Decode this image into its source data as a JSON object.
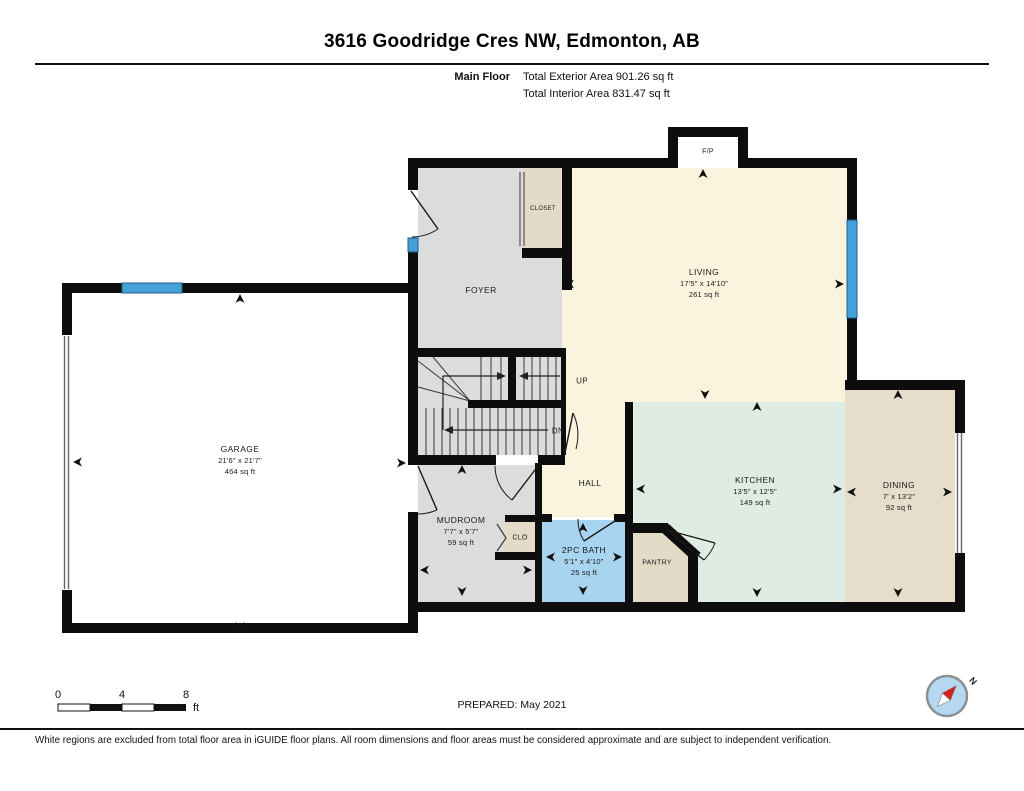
{
  "header": {
    "title": "3616 Goodridge Cres NW, Edmonton, AB"
  },
  "subheader": {
    "floor_label": "Main Floor",
    "exterior_area": "Total Exterior Area 901.26 sq ft",
    "interior_area": "Total Interior Area 831.47 sq ft"
  },
  "rooms": [
    {
      "id": "living",
      "name": "LIVING",
      "dims": "17'5\" x 14'10\"",
      "area": "261 sq ft"
    },
    {
      "id": "garage",
      "name": "GARAGE",
      "dims": "21'6\" x 21'7\"",
      "area": "464 sq ft"
    },
    {
      "id": "kitchen",
      "name": "KITCHEN",
      "dims": "13'5\" x 12'5\"",
      "area": "149 sq ft"
    },
    {
      "id": "dining",
      "name": "DINING",
      "dims": "7' x 13'2\"",
      "area": "92 sq ft"
    },
    {
      "id": "mudroom",
      "name": "MUDROOM",
      "dims": "7'7\" x 5'7\"",
      "area": "59 sq ft"
    },
    {
      "id": "bath",
      "name": "2PC BATH",
      "dims": "5'1\" x 4'10\"",
      "area": "25 sq ft"
    },
    {
      "id": "foyer",
      "name": "FOYER"
    },
    {
      "id": "hall",
      "name": "HALL"
    }
  ],
  "labels": {
    "fireplace": "F/P",
    "closet": "CLOSET",
    "clo": "CLO",
    "pantry": "PANTRY",
    "up": "UP",
    "dn": "DN"
  },
  "scale_bar": {
    "tick0": "0",
    "tick4": "4",
    "tick8": "8",
    "unit": "ft"
  },
  "compass": {
    "north": "N"
  },
  "footer": {
    "prepared": "PREPARED: May 2021",
    "disclaimer": "White regions are excluded from total floor area in iGUIDE floor plans. All room dimensions and floor areas must be considered approximate and are subject to independent verification."
  },
  "colors": {
    "wall": "#0d0d0d",
    "living_cream": "#faf3dd",
    "gray_floor": "#dcdcdc",
    "tan_floor": "#e3dbc7",
    "dining_tan": "#e6decb",
    "kitchen_mint": "#dfece4",
    "bath_blue": "#a9d4ef",
    "window_blue": "#44a0d6",
    "compass_blue": "#b5d8f1",
    "compass_red": "#d42020"
  }
}
